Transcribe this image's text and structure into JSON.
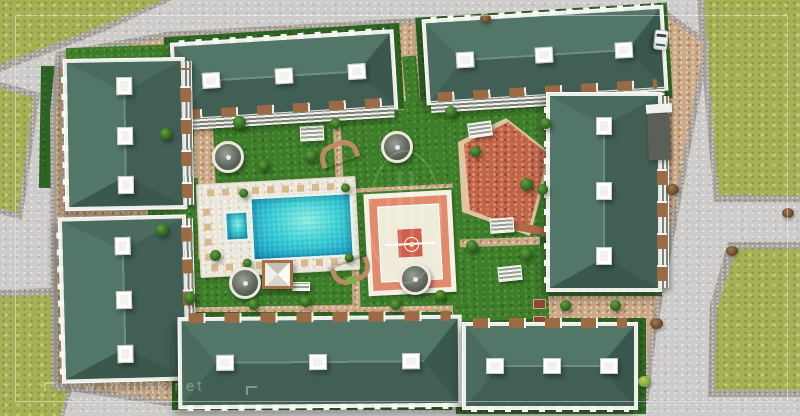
{
  "watermarks": {
    "site_url": "www.imtilak.net",
    "site_url_top": "www.imtilak.net"
  },
  "colors": {
    "road": "#cdccca",
    "curb": "#a8a29b",
    "olive": "#a6b157",
    "green": "#3e7e2b",
    "dgreen": "#2d6322",
    "tan": "#c9a987",
    "roof_top": "#527667",
    "roof_bottom": "#415f54",
    "roof_left": "#4a6b5e",
    "roof_right": "#3a584c",
    "ridge": "#6e8e80",
    "bld_white": "#eceeea",
    "balcony": "#9c6b44",
    "lounger": "#d8b98e",
    "salmon": "#e28a6c",
    "cream": "#efecdc",
    "court_red": "#cf5f49",
    "brick": "#c2664a"
  }
}
